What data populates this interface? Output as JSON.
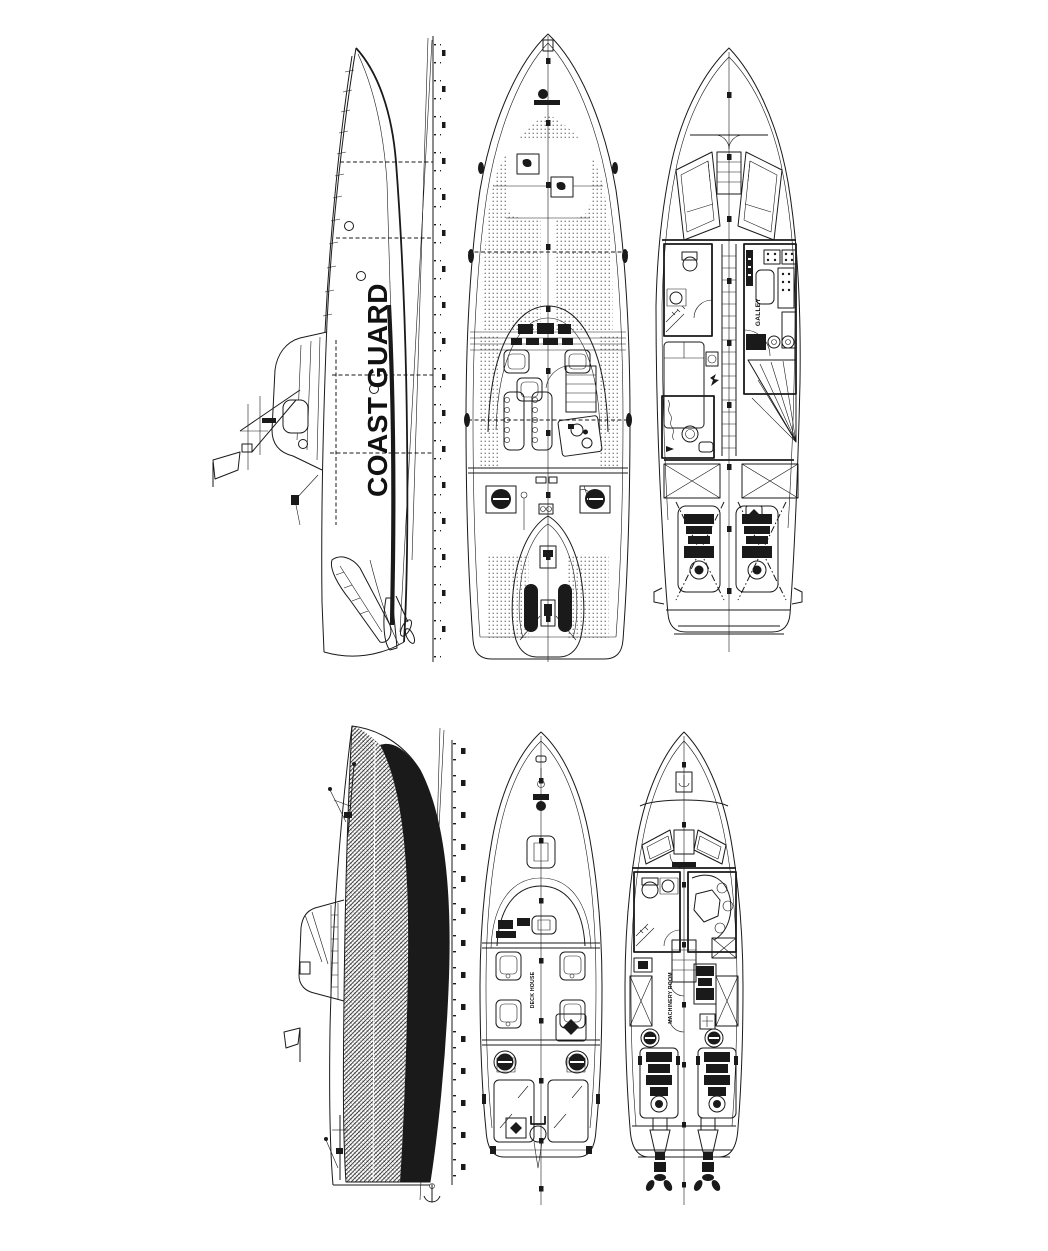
{
  "sheet": {
    "background": "#ffffff",
    "ink": "#1a1a1a",
    "content": "Two-boat technical drawing sheet: each boat shown as outboard profile, main deck plan and interior arrangement plan, drawn bow-up"
  },
  "labels": {
    "hull_name": "COAST GUARD",
    "galley": "GALLEY",
    "deck_house": "DECK HOUSE",
    "machinery_room": "MACHINERY ROOM"
  }
}
